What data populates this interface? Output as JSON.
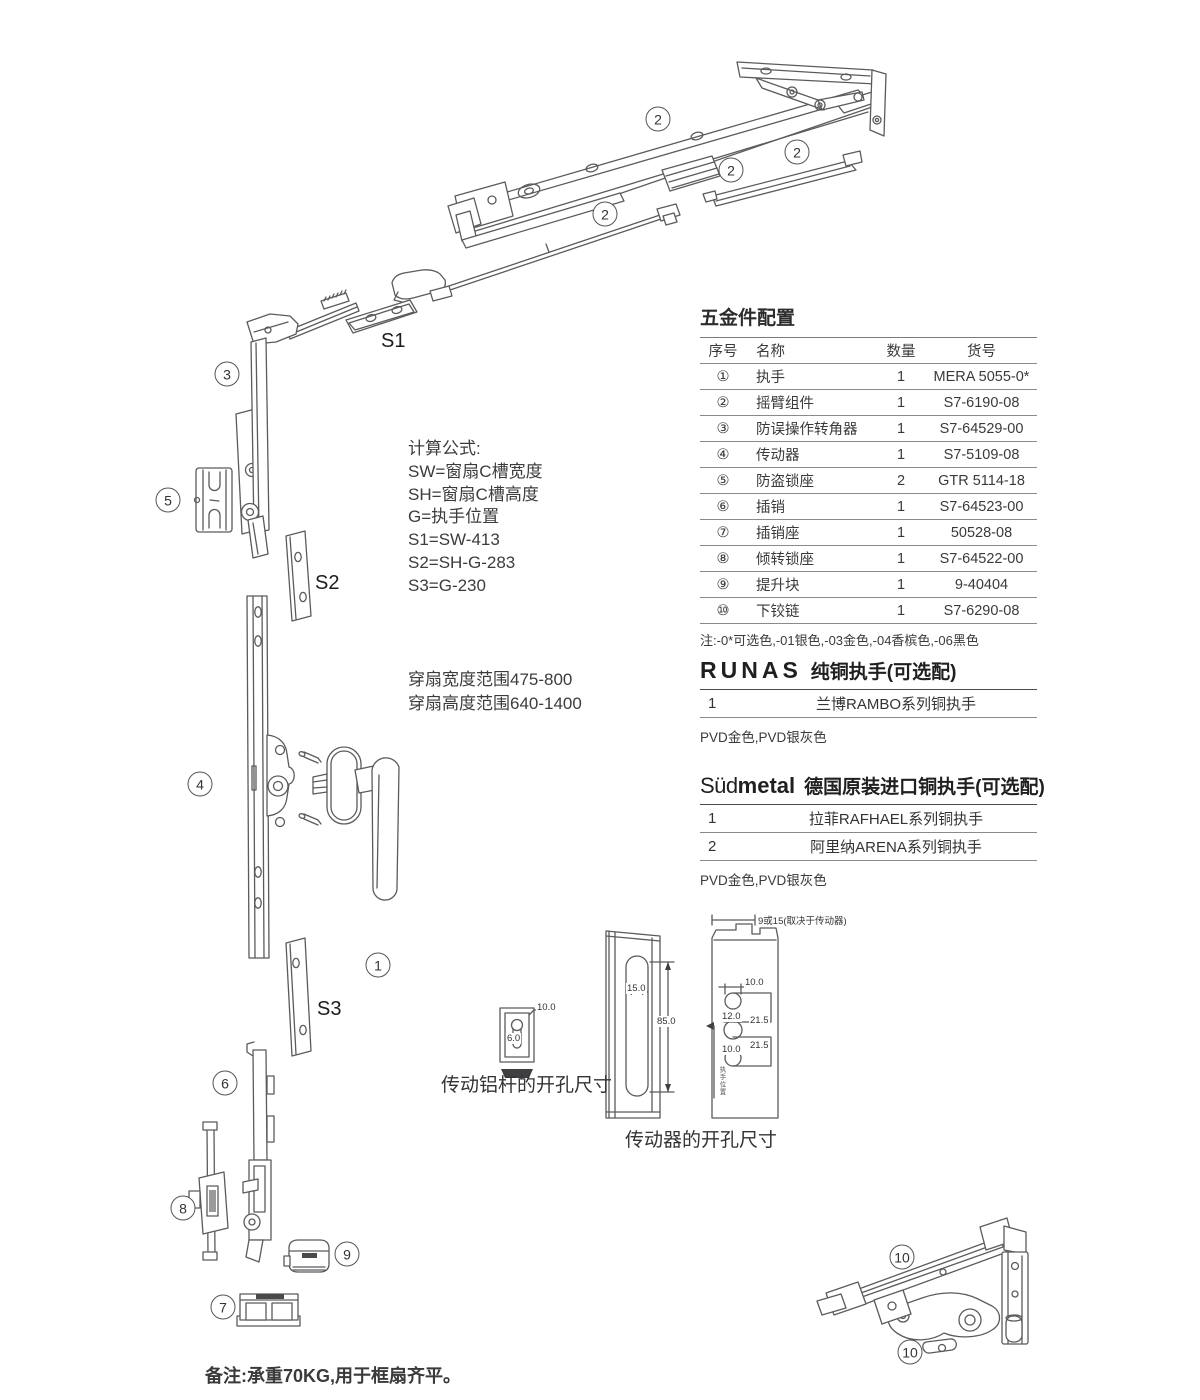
{
  "sheet": {
    "foot_note": "备注:承重70KG,用于框扇齐平。"
  },
  "formulas": {
    "title": "计算公式:",
    "lines": [
      "SW=窗扇C槽宽度",
      "SH=窗扇C槽高度",
      "G=执手位置",
      "S1=SW-413",
      "S2=SH-G-283",
      "S3=G-230"
    ]
  },
  "ranges": {
    "width": "穿扇宽度范围475-800",
    "height": "穿扇高度范围640-1400"
  },
  "hardware_table": {
    "title": "五金件配置",
    "headers": {
      "no": "序号",
      "name": "名称",
      "qty": "数量",
      "code": "货号"
    },
    "rows": [
      {
        "no": "①",
        "name": "执手",
        "qty": "1",
        "code": "MERA 5055-0*"
      },
      {
        "no": "②",
        "name": "摇臂组件",
        "qty": "1",
        "code": "S7-6190-08"
      },
      {
        "no": "③",
        "name": "防误操作转角器",
        "qty": "1",
        "code": "S7-64529-00"
      },
      {
        "no": "④",
        "name": "传动器",
        "qty": "1",
        "code": "S7-5109-08"
      },
      {
        "no": "⑤",
        "name": "防盗锁座",
        "qty": "2",
        "code": "GTR 5114-18"
      },
      {
        "no": "⑥",
        "name": "插销",
        "qty": "1",
        "code": "S7-64523-00"
      },
      {
        "no": "⑦",
        "name": "插销座",
        "qty": "1",
        "code": "50528-08"
      },
      {
        "no": "⑧",
        "name": "倾转锁座",
        "qty": "1",
        "code": "S7-64522-00"
      },
      {
        "no": "⑨",
        "name": "提升块",
        "qty": "1",
        "code": "9-40404"
      },
      {
        "no": "⑩",
        "name": "下铰链",
        "qty": "1",
        "code": "S7-6290-08"
      }
    ],
    "note": "注:-0*可选色,-01银色,-03金色,-04香槟色,-06黑色"
  },
  "runas": {
    "brand": "RUNAS",
    "title": "纯铜执手(可选配)",
    "rows": [
      {
        "no": "1",
        "name": "兰博RAMBO系列铜执手"
      }
    ],
    "finish": "PVD金色,PVD银灰色"
  },
  "sudmetal": {
    "brand_light": "Süd",
    "brand_bold": "metal",
    "title": "德国原装进口铜执手(可选配)",
    "rows": [
      {
        "no": "1",
        "name": "拉菲RAFHAEL系列铜执手"
      },
      {
        "no": "2",
        "name": "阿里纳ARENA系列铜执手"
      }
    ],
    "finish": "PVD金色,PVD银灰色"
  },
  "diagram": {
    "part_labels": [
      {
        "text": "2"
      },
      {
        "text": "2"
      },
      {
        "text": "2"
      },
      {
        "text": "2"
      },
      {
        "text": "3"
      },
      {
        "text": "5"
      },
      {
        "text": "4"
      },
      {
        "text": "1"
      },
      {
        "text": "6"
      },
      {
        "text": "8"
      },
      {
        "text": "9"
      },
      {
        "text": "7"
      },
      {
        "text": "10"
      },
      {
        "text": "10"
      }
    ],
    "size_labels": {
      "s1": "S1",
      "s2": "S2",
      "s3": "S3"
    },
    "captions": {
      "rod": "传动铝杆的开孔尺寸",
      "gear": "传动器的开孔尺寸"
    },
    "dims": {
      "rod_width": "10.0",
      "rod_slot": "6.0",
      "slot_width": "15.0",
      "slot_height": "85.0",
      "offset": "9或15(取决于传动器)",
      "top_hole": "10.0",
      "mid_hole": "12.0",
      "step_a": "21.5",
      "bottom_hole": "10.0",
      "step_b": "21.5",
      "handle_pos": "执手位置"
    }
  }
}
